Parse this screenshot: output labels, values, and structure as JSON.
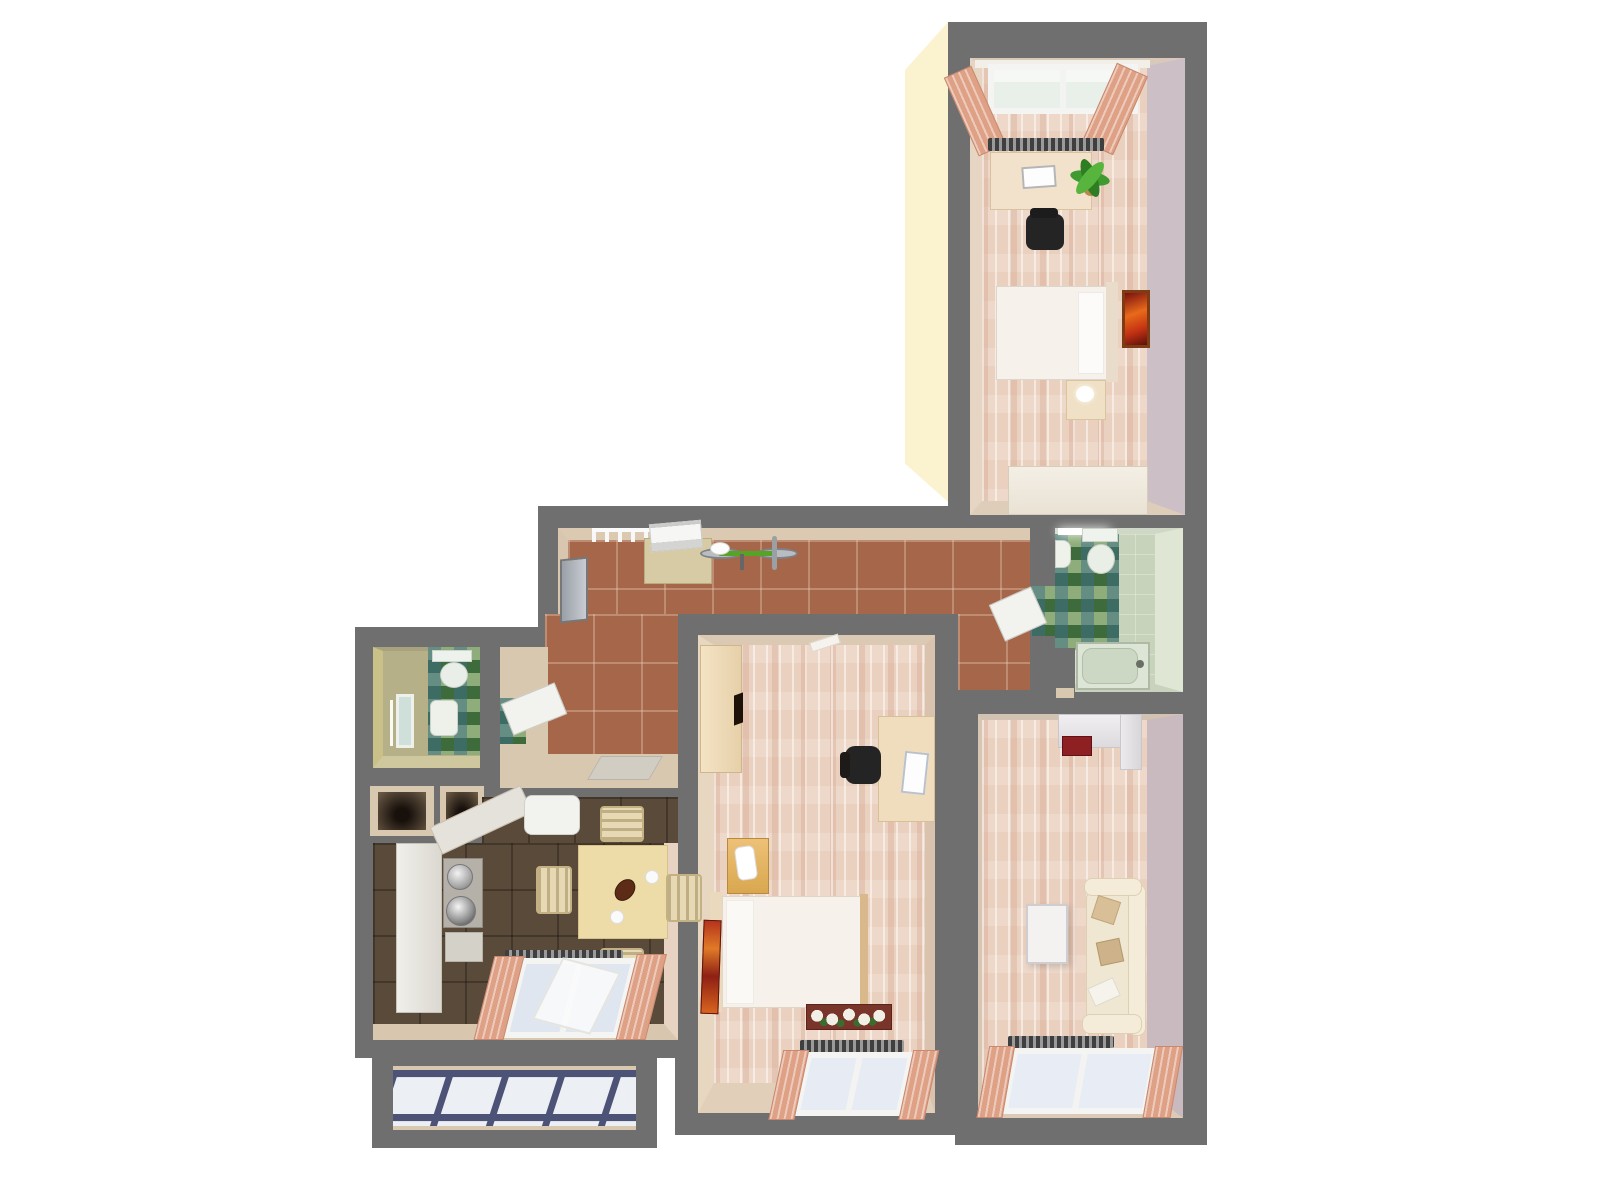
{
  "meta": {
    "type": "3d-floor-plan-render",
    "view": "top-down isometric",
    "description": "Rendered apartment floor plan with gray walls on white background"
  },
  "palette": {
    "background": "#ffffff",
    "wall": "#6f6f6f",
    "exterior": "#fbf3d0",
    "hallTile": "#a5664a",
    "kitchenTile": "#5a4a39",
    "wood": "#ead0bf",
    "mosaicGreen": "#55824a",
    "celadon": "#c7d3ba",
    "wcFloor": "#b6b088",
    "beigeFace": "#d9c8b0",
    "balconyTile": "#eceff3",
    "balconyGrout": "#4d5377",
    "curtain": "#dfa185",
    "creamFurniture": "#f3e2cb",
    "tableWood": "#eddca8",
    "amberNightstand": "#e0b05e",
    "bedWhite": "#f6f1ea",
    "sofaCream": "#efe7d2",
    "chairBlack": "#242424",
    "doorWhite": "#f2f2ef",
    "accentRed": "#8e2024",
    "paintingOrange": "#e86a1a",
    "rugRed": "#b5341c",
    "plantGreen": "#3f9a2f"
  },
  "scene": {
    "rooms": [
      {
        "id": "bedroom-top",
        "floor": "light pink parquet",
        "furniture": [
          "window with salmon curtains",
          "radiator",
          "desk with laptop",
          "office chair",
          "potted plant",
          "double bed",
          "wall painting",
          "nightstand with lamp",
          "dresser"
        ]
      },
      {
        "id": "entrance-hall",
        "floor": "terracotta tile",
        "furniture": [
          "entry door",
          "coat rack",
          "shoe cabinet with printer",
          "bicycle",
          "wc door",
          "bathroom door",
          "doormat"
        ]
      },
      {
        "id": "bathroom",
        "floor": "green mosaic and celadon tile",
        "furniture": [
          "ceiling light",
          "sink",
          "toilet",
          "bathtub",
          "partition wall"
        ]
      },
      {
        "id": "wc",
        "floor": "olive tile with green mosaic strip",
        "furniture": [
          "toilet",
          "sink",
          "mirror"
        ]
      },
      {
        "id": "storage-niches",
        "floor": "dark recesses",
        "furniture": []
      },
      {
        "id": "kitchen",
        "floor": "dark brown tile",
        "furniture": [
          "counter",
          "corner counter",
          "fridge",
          "stove with pots",
          "base cabinet",
          "dining table",
          "teapot",
          "plates",
          "four chairs",
          "window with salmon curtains"
        ]
      },
      {
        "id": "bedroom-center",
        "floor": "light pink parquet",
        "furniture": [
          "wardrobe",
          "desk with laptop",
          "office chair",
          "nightstand with lamp",
          "double bed",
          "rug",
          "flower box",
          "radiator",
          "window with salmon curtains"
        ]
      },
      {
        "id": "living-room",
        "floor": "light pink parquet",
        "furniture": [
          "wall shelf with red book",
          "coffee table",
          "sofa with pillows",
          "radiator",
          "window with salmon curtains"
        ]
      },
      {
        "id": "balcony",
        "floor": "white tile with blue grout",
        "furniture": []
      }
    ]
  }
}
